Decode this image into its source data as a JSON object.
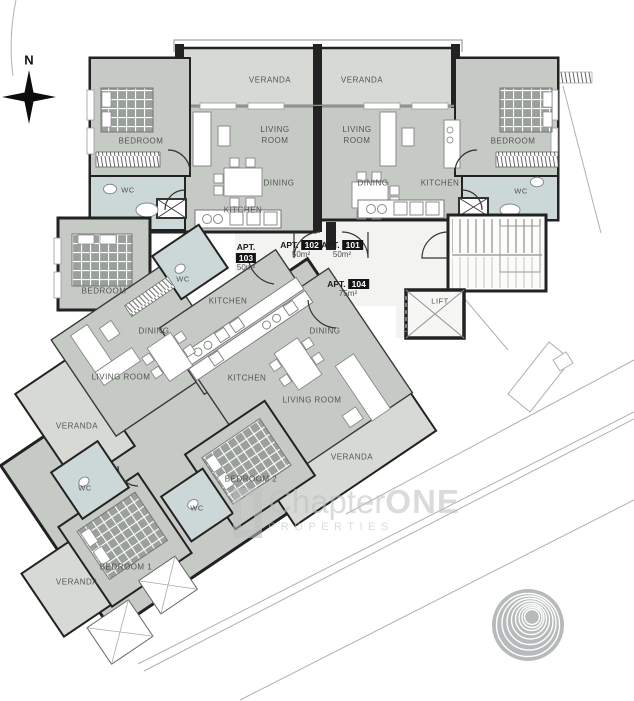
{
  "compass": {
    "north": "N"
  },
  "core": {
    "lift": "LIFT"
  },
  "apartments": {
    "apt_102": {
      "tag": {
        "prefix": "APT.",
        "number": "102",
        "area": "50m²"
      },
      "rooms": {
        "veranda": "VERANDA",
        "living_room": "LIVING ROOM",
        "dining": "DINING",
        "kitchen": "KITCHEN",
        "bedroom": "BEDROOM",
        "wc": "WC"
      }
    },
    "apt_101": {
      "tag": {
        "prefix": "APT.",
        "number": "101",
        "area": "50m²"
      },
      "rooms": {
        "veranda": "VERANDA",
        "living_room": "LIVING ROOM",
        "dining": "DINING",
        "kitchen": "KITCHEN",
        "bedroom": "BEDROOM",
        "wc": "WC"
      }
    },
    "apt_103": {
      "tag": {
        "prefix": "APT.",
        "number": "103",
        "area": "50m²"
      },
      "rooms": {
        "bedroom": "BEDROOM",
        "wc": "WC",
        "kitchen": "KITCHEN",
        "dining": "DINING",
        "living_room": "LIVING ROOM",
        "veranda": "VERANDA"
      }
    },
    "apt_104": {
      "tag": {
        "prefix": "APT.",
        "number": "104",
        "area": "75m²"
      },
      "rooms": {
        "kitchen": "KITCHEN",
        "dining": "DINING",
        "living_room": "LIVING ROOM",
        "bedroom_1": "BEDROOM 1",
        "bedroom_2": "BEDROOM 2",
        "wc_1": "WC",
        "wc_2": "WC",
        "veranda_bottom": "VERANDA",
        "veranda_side": "VERANDA"
      }
    }
  },
  "watermark": {
    "brand_regular": "Chapter",
    "brand_bold": "ONE",
    "subtitle": "PROPERTIES"
  },
  "colors": {
    "room_fill": "#c6cac5",
    "veranda_fill": "#d7dad4",
    "wc_fill": "#ccd8d7",
    "wall_dark": "#222222",
    "wall_gray": "#8e9290",
    "hall_fill": "#f3f4f1",
    "watermark_gray": "#bcc0c1",
    "logo_gray": "#b7babb"
  }
}
